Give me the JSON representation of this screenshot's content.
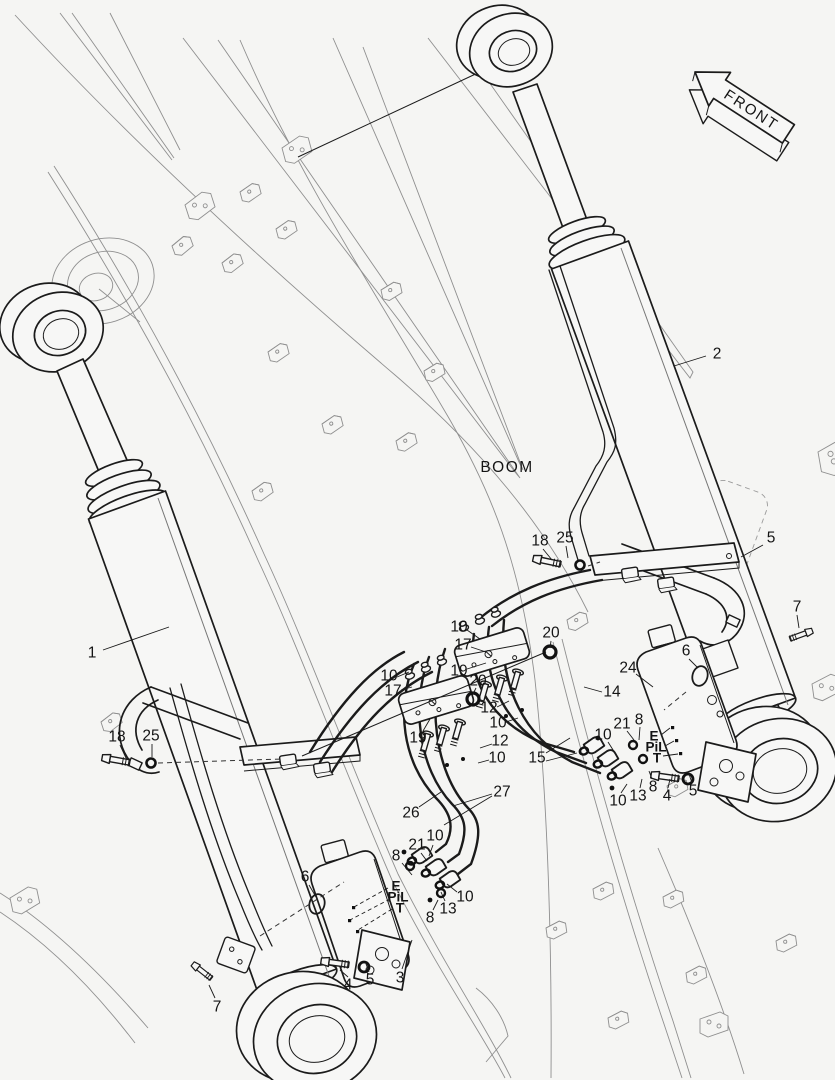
{
  "figure": {
    "boom_label": "BOOM",
    "front_label": "FRONT",
    "line_color": "#1b1b1b",
    "secondary_line_color": "#8f8f8f",
    "background_color": "#f5f5f3"
  },
  "callouts": [
    {
      "part": "1",
      "x": 92,
      "y": 653,
      "leaders": [
        [
          103,
          650,
          169,
          627
        ]
      ]
    },
    {
      "part": "2",
      "x": 717,
      "y": 354,
      "leaders": [
        [
          706,
          356,
          674,
          366
        ]
      ]
    },
    {
      "part": "18",
      "x": 117,
      "y": 737,
      "leaders": [
        [
          120,
          745,
          126,
          758
        ]
      ]
    },
    {
      "part": "25",
      "x": 151,
      "y": 736,
      "leaders": [
        [
          152,
          744,
          152,
          757
        ]
      ]
    },
    {
      "part": "7",
      "x": 217,
      "y": 1007,
      "leaders": [
        [
          215,
          998,
          209,
          985
        ]
      ]
    },
    {
      "part": "6",
      "x": 305,
      "y": 877,
      "leaders": [
        [
          309,
          885,
          316,
          897
        ]
      ]
    },
    {
      "part": "4",
      "x": 348,
      "y": 985,
      "leaders": [
        [
          348,
          977,
          340,
          970
        ]
      ]
    },
    {
      "part": "5",
      "x": 370,
      "y": 980,
      "leaders": [
        [
          369,
          972,
          366,
          964
        ]
      ]
    },
    {
      "part": "3",
      "x": 400,
      "y": 978,
      "leaders": [
        [
          402,
          969,
          412,
          940
        ]
      ]
    },
    {
      "part": "8",
      "x": 396,
      "y": 856,
      "leaders": [
        [
          402,
          863,
          412,
          875
        ]
      ]
    },
    {
      "part": "21",
      "x": 417,
      "y": 845,
      "leaders": [
        [
          421,
          853,
          427,
          861
        ]
      ]
    },
    {
      "part": "10",
      "x": 435,
      "y": 836,
      "leaders": [
        [
          433,
          845,
          429,
          856
        ]
      ]
    },
    {
      "part": "10",
      "x": 465,
      "y": 897,
      "leaders": [
        [
          457,
          892,
          447,
          884
        ]
      ]
    },
    {
      "part": "13",
      "x": 448,
      "y": 909,
      "leaders": [
        [
          445,
          901,
          441,
          892
        ]
      ]
    },
    {
      "part": "8",
      "x": 430,
      "y": 918,
      "leaders": [
        [
          433,
          910,
          438,
          900
        ]
      ]
    },
    {
      "part": "E",
      "x": 396,
      "y": 886,
      "bold": true,
      "dashed": true,
      "leaders": [
        [
          388,
          888,
          354,
          907
        ]
      ]
    },
    {
      "part": "PiL",
      "x": 398,
      "y": 897,
      "bold": true,
      "dashed": true,
      "leaders": [
        [
          390,
          899,
          350,
          920
        ]
      ]
    },
    {
      "part": "T",
      "x": 400,
      "y": 908,
      "bold": true,
      "dashed": true,
      "leaders": [
        [
          392,
          909,
          358,
          930
        ]
      ]
    },
    {
      "part": "10",
      "x": 389,
      "y": 676,
      "leaders": [
        [
          397,
          677,
          409,
          672
        ]
      ]
    },
    {
      "part": "17",
      "x": 393,
      "y": 691,
      "leaders": [
        [
          401,
          690,
          412,
          687
        ]
      ]
    },
    {
      "part": "19",
      "x": 418,
      "y": 738,
      "leaders": [
        [
          423,
          731,
          430,
          719
        ]
      ]
    },
    {
      "part": "20",
      "x": 478,
      "y": 681,
      "leaders": [
        [
          476,
          688,
          473,
          694
        ]
      ]
    },
    {
      "part": "10",
      "x": 459,
      "y": 627,
      "leaders": [
        [
          467,
          630,
          480,
          639
        ]
      ]
    },
    {
      "part": "17",
      "x": 463,
      "y": 645,
      "leaders": [
        [
          471,
          647,
          486,
          652
        ]
      ]
    },
    {
      "part": "19",
      "x": 459,
      "y": 671,
      "leaders": [
        [
          467,
          669,
          486,
          663
        ]
      ]
    },
    {
      "part": "20",
      "x": 551,
      "y": 633,
      "leaders": [
        [
          551,
          641,
          550,
          648
        ]
      ]
    },
    {
      "part": "12",
      "x": 489,
      "y": 708,
      "leaders": [
        [
          497,
          707,
          509,
          701
        ]
      ]
    },
    {
      "part": "10",
      "x": 498,
      "y": 723,
      "leaders": [
        [
          506,
          722,
          518,
          718
        ]
      ]
    },
    {
      "part": "12",
      "x": 500,
      "y": 741,
      "leaders": [
        [
          492,
          744,
          480,
          748
        ]
      ]
    },
    {
      "part": "10",
      "x": 497,
      "y": 758,
      "leaders": [
        [
          489,
          760,
          478,
          763
        ]
      ]
    },
    {
      "part": "15",
      "x": 537,
      "y": 758,
      "leaders": [
        [
          546,
          753,
          570,
          738
        ],
        [
          546,
          761,
          577,
          753
        ]
      ]
    },
    {
      "part": "14",
      "x": 612,
      "y": 692,
      "leaders": [
        [
          602,
          692,
          584,
          687
        ]
      ]
    },
    {
      "part": "18",
      "x": 540,
      "y": 541,
      "leaders": [
        [
          543,
          549,
          552,
          560
        ]
      ]
    },
    {
      "part": "25",
      "x": 565,
      "y": 538,
      "leaders": [
        [
          566,
          546,
          568,
          558
        ]
      ]
    },
    {
      "part": "24",
      "x": 628,
      "y": 668,
      "leaders": [
        [
          636,
          674,
          653,
          687
        ]
      ]
    },
    {
      "part": "6",
      "x": 686,
      "y": 651,
      "leaders": [
        [
          689,
          659,
          698,
          668
        ]
      ]
    },
    {
      "part": "21",
      "x": 622,
      "y": 724,
      "leaders": [
        [
          627,
          731,
          634,
          740
        ]
      ]
    },
    {
      "part": "8",
      "x": 639,
      "y": 720,
      "leaders": [
        [
          640,
          727,
          639,
          740
        ]
      ]
    },
    {
      "part": "10",
      "x": 603,
      "y": 735,
      "leaders": [
        [
          608,
          742,
          615,
          753
        ]
      ]
    },
    {
      "part": "E",
      "x": 654,
      "y": 736,
      "bold": true,
      "leaders": [
        [
          661,
          735,
          670,
          728
        ]
      ]
    },
    {
      "part": "PiL",
      "x": 656,
      "y": 747,
      "bold": true,
      "leaders": [
        [
          665,
          746,
          674,
          741
        ]
      ]
    },
    {
      "part": "T",
      "x": 657,
      "y": 758,
      "bold": true,
      "leaders": [
        [
          663,
          756,
          678,
          754
        ]
      ]
    },
    {
      "part": "10",
      "x": 618,
      "y": 801,
      "leaders": [
        [
          621,
          793,
          627,
          784
        ]
      ]
    },
    {
      "part": "13",
      "x": 638,
      "y": 796,
      "leaders": [
        [
          640,
          788,
          642,
          779
        ]
      ]
    },
    {
      "part": "8",
      "x": 653,
      "y": 787,
      "leaders": [
        [
          652,
          779,
          649,
          771
        ]
      ]
    },
    {
      "part": "4",
      "x": 667,
      "y": 796,
      "leaders": [
        [
          668,
          788,
          670,
          779
        ]
      ]
    },
    {
      "part": "5",
      "x": 693,
      "y": 791,
      "leaders": [
        [
          692,
          783,
          689,
          774
        ]
      ]
    },
    {
      "part": "5",
      "x": 771,
      "y": 538,
      "leaders": [
        [
          763,
          545,
          741,
          557
        ]
      ]
    },
    {
      "part": "7",
      "x": 797,
      "y": 607,
      "leaders": [
        [
          797,
          615,
          799,
          628
        ]
      ]
    },
    {
      "part": "26",
      "x": 411,
      "y": 813,
      "leaders": [
        [
          419,
          807,
          441,
          792
        ]
      ]
    },
    {
      "part": "27",
      "x": 502,
      "y": 792,
      "leaders": [
        [
          492,
          794,
          453,
          806
        ],
        [
          492,
          796,
          444,
          825
        ]
      ]
    }
  ]
}
